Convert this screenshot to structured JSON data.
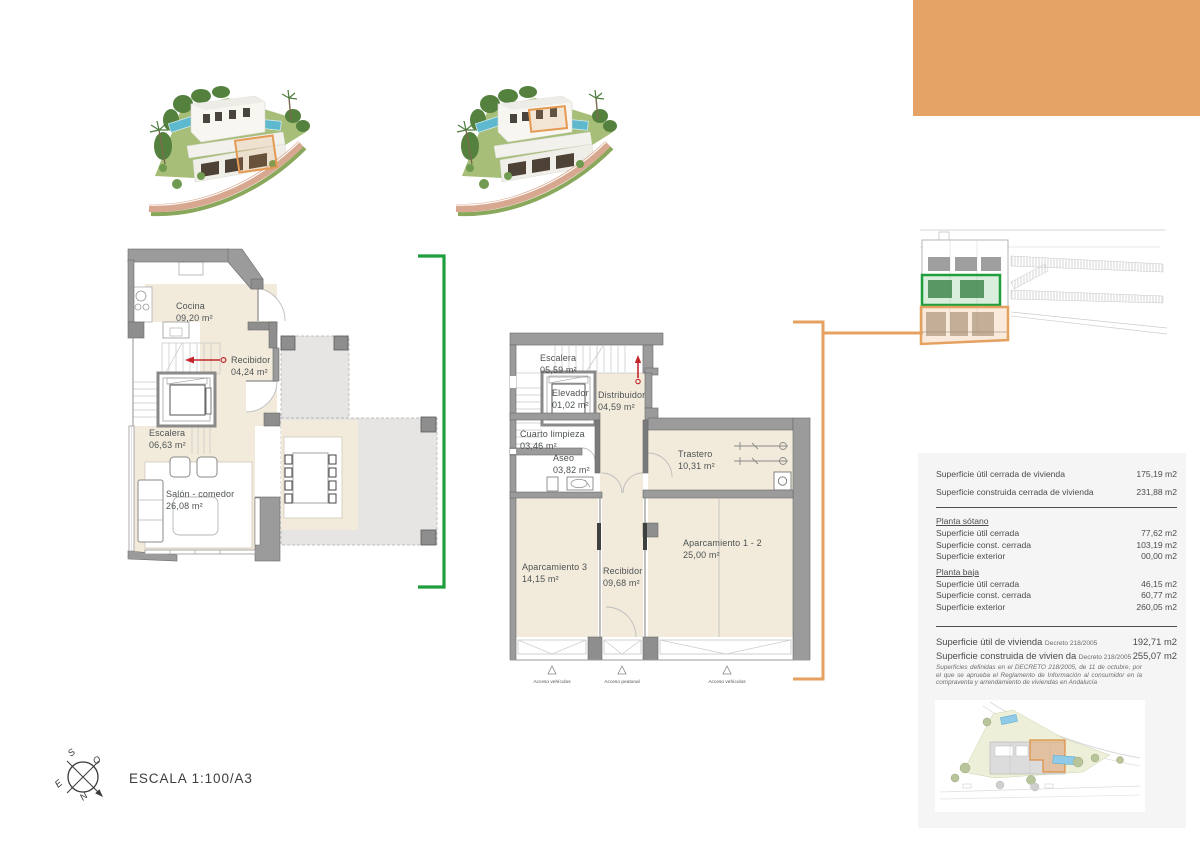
{
  "colors": {
    "accent_orange": "#E5A465",
    "accent_green": "#1E9E3C",
    "arrow_red": "#C1272D"
  },
  "scale": {
    "label": "ESCALA 1:100/A3"
  },
  "compass": {
    "n": "N",
    "s": "S",
    "e": "E",
    "o": "O"
  },
  "plan_baja": {
    "rooms": {
      "cocina": {
        "name": "Cocina",
        "area": "09,20 m²"
      },
      "recibidor": {
        "name": "Recibidor",
        "area": "04,24 m²"
      },
      "escalera": {
        "name": "Escalera",
        "area": "06,63 m²"
      },
      "salon": {
        "name": "Salón - comedor",
        "area": "26,08 m²"
      }
    }
  },
  "plan_sotano": {
    "rooms": {
      "escalera": {
        "name": "Escalera",
        "area": "05,59 m²"
      },
      "elevador": {
        "name": "Elevador",
        "area": "01,02 m²"
      },
      "distribuidor": {
        "name": "Distribuidor",
        "area": "04,59 m²"
      },
      "cuarto": {
        "name": "Cuarto limpieza",
        "area": "03,46 m²"
      },
      "aseo": {
        "name": "Aseo",
        "area": "03,82 m²"
      },
      "trastero": {
        "name": "Trastero",
        "area": "10,31 m²"
      },
      "aparcamiento3": {
        "name": "Aparcamiento 3",
        "area": "14,15 m²"
      },
      "recibidor": {
        "name": "Recibidor",
        "area": "09,68 m²"
      },
      "aparcamiento12": {
        "name": "Aparcamiento 1 - 2",
        "area": "25,00 m²"
      }
    },
    "access": [
      "Acceso vehículos",
      "Acceso peatonal",
      "Acceso vehículos"
    ]
  },
  "summary": {
    "totals": [
      {
        "label": "Superficie útil cerrada de vivienda",
        "value": "175,19 m2"
      },
      {
        "label": "Superficie construida cerrada de vivienda",
        "value": "231,88 m2"
      }
    ],
    "sections": [
      {
        "title": "Planta sótano",
        "rows": [
          {
            "label": "Superficie útil cerrada",
            "value": "77,62 m2"
          },
          {
            "label": "Superficie const. cerrada",
            "value": "103,19 m2"
          },
          {
            "label": "Superficie exterior",
            "value": "00,00 m2"
          }
        ]
      },
      {
        "title": "Planta baja",
        "rows": [
          {
            "label": "Superficie útil cerrada",
            "value": "46,15 m2"
          },
          {
            "label": "Superficie const. cerrada",
            "value": "60,77 m2"
          },
          {
            "label": "Superficie exterior",
            "value": "260,05 m2"
          }
        ]
      }
    ],
    "decreto_rows": [
      {
        "label": "Superficie útil de vivienda",
        "decreto": "Decreto 218/2005",
        "value": "192,71 m2"
      },
      {
        "label": "Superficie construida de vivien da",
        "decreto": "Decreto 218/2005",
        "value": "255,07 m2"
      }
    ],
    "legal_note": "Superficies definidas en el DECRETO 218/2005, de 11 de octubre, por el que se aprueba el Reglamento de Información al consumidor en la compraventa y arrendamiento de viviendas en Andalucía"
  }
}
